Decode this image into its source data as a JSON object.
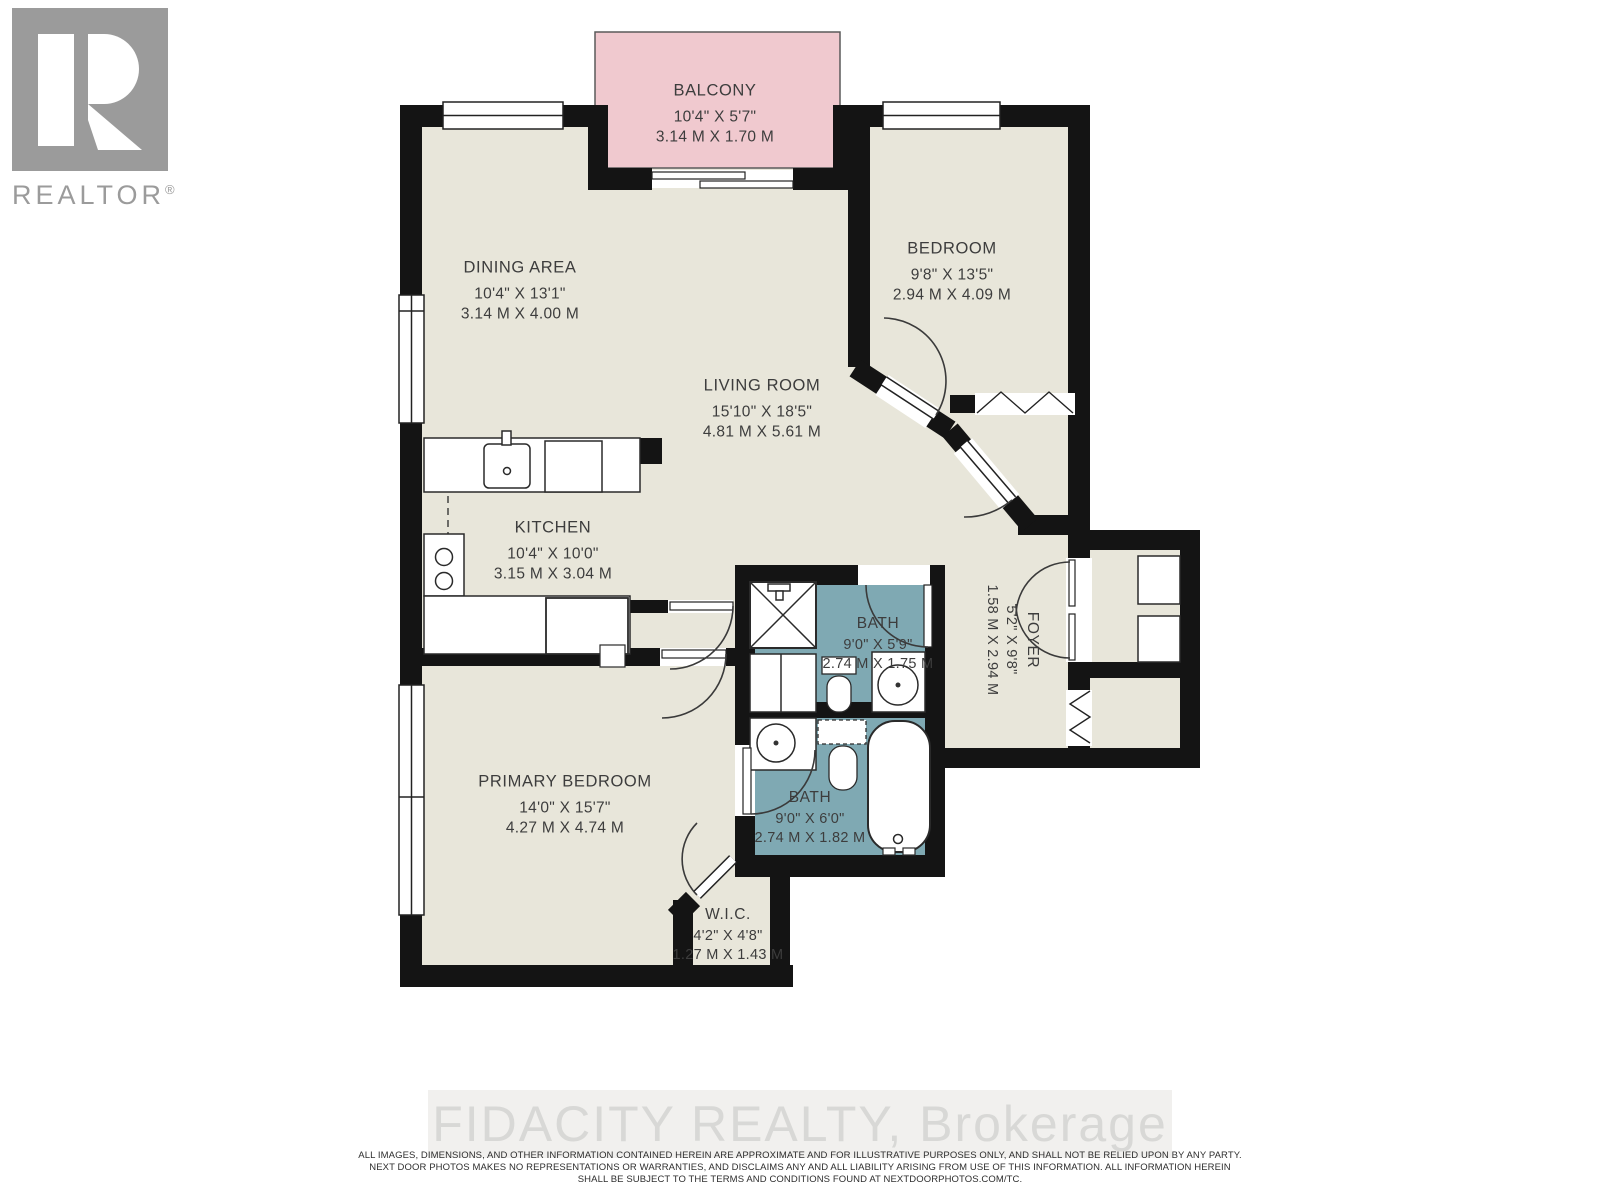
{
  "branding": {
    "logo_text": "REALTOR",
    "registered_mark": "®"
  },
  "colors": {
    "floor": "#e8e6da",
    "bath": "#7fa9b3",
    "balcony": "#f0c9cf",
    "wall": "#141414"
  },
  "rooms": [
    {
      "id": "balcony",
      "name": "BALCONY",
      "imperial": "10'4\" X 5'7\"",
      "metric": "3.14 M X 1.70 M"
    },
    {
      "id": "dining",
      "name": "DINING AREA",
      "imperial": "10'4\" X 13'1\"",
      "metric": "3.14 M X 4.00 M"
    },
    {
      "id": "bedroom",
      "name": "BEDROOM",
      "imperial": "9'8\" X 13'5\"",
      "metric": "2.94 M X 4.09 M"
    },
    {
      "id": "living",
      "name": "LIVING ROOM",
      "imperial": "15'10\" X 18'5\"",
      "metric": "4.81 M X 5.61 M"
    },
    {
      "id": "kitchen",
      "name": "KITCHEN",
      "imperial": "10'4\" X 10'0\"",
      "metric": "3.15 M X 3.04 M"
    },
    {
      "id": "bath-main",
      "name": "BATH",
      "imperial": "9'0\" X 5'9\"",
      "metric": "2.74 M X 1.75 M"
    },
    {
      "id": "foyer",
      "name": "FOYER",
      "imperial": "5'2\" X 9'8\"",
      "metric": "1.58 M X 2.94 M"
    },
    {
      "id": "bath-ensuite",
      "name": "BATH",
      "imperial": "9'0\" X 6'0\"",
      "metric": "2.74 M X 1.82 M"
    },
    {
      "id": "primary-bedroom",
      "name": "PRIMARY BEDROOM",
      "imperial": "14'0\" X 15'7\"",
      "metric": "4.27 M X 4.74 M"
    },
    {
      "id": "wic",
      "name": "W.I.C.",
      "imperial": "4'2\" X 4'8\"",
      "metric": "1.27 M X 1.43 M"
    }
  ],
  "footer": {
    "watermark": "FIDACITY REALTY, Brokerage",
    "disclaimer_line1": "ALL IMAGES, DIMENSIONS, AND OTHER INFORMATION CONTAINED HEREIN ARE APPROXIMATE AND FOR ILLUSTRATIVE PURPOSES ONLY, AND SHALL NOT BE RELIED UPON BY ANY PARTY.",
    "disclaimer_line2": "NEXT DOOR PHOTOS MAKES NO REPRESENTATIONS OR WARRANTIES, AND DISCLAIMS ANY AND ALL LIABILITY ARISING FROM USE OF THIS INFORMATION. ALL INFORMATION HEREIN",
    "disclaimer_line3": "SHALL BE SUBJECT TO THE TERMS AND CONDITIONS FOUND AT NEXTDOORPHOTOS.COM/TC."
  }
}
